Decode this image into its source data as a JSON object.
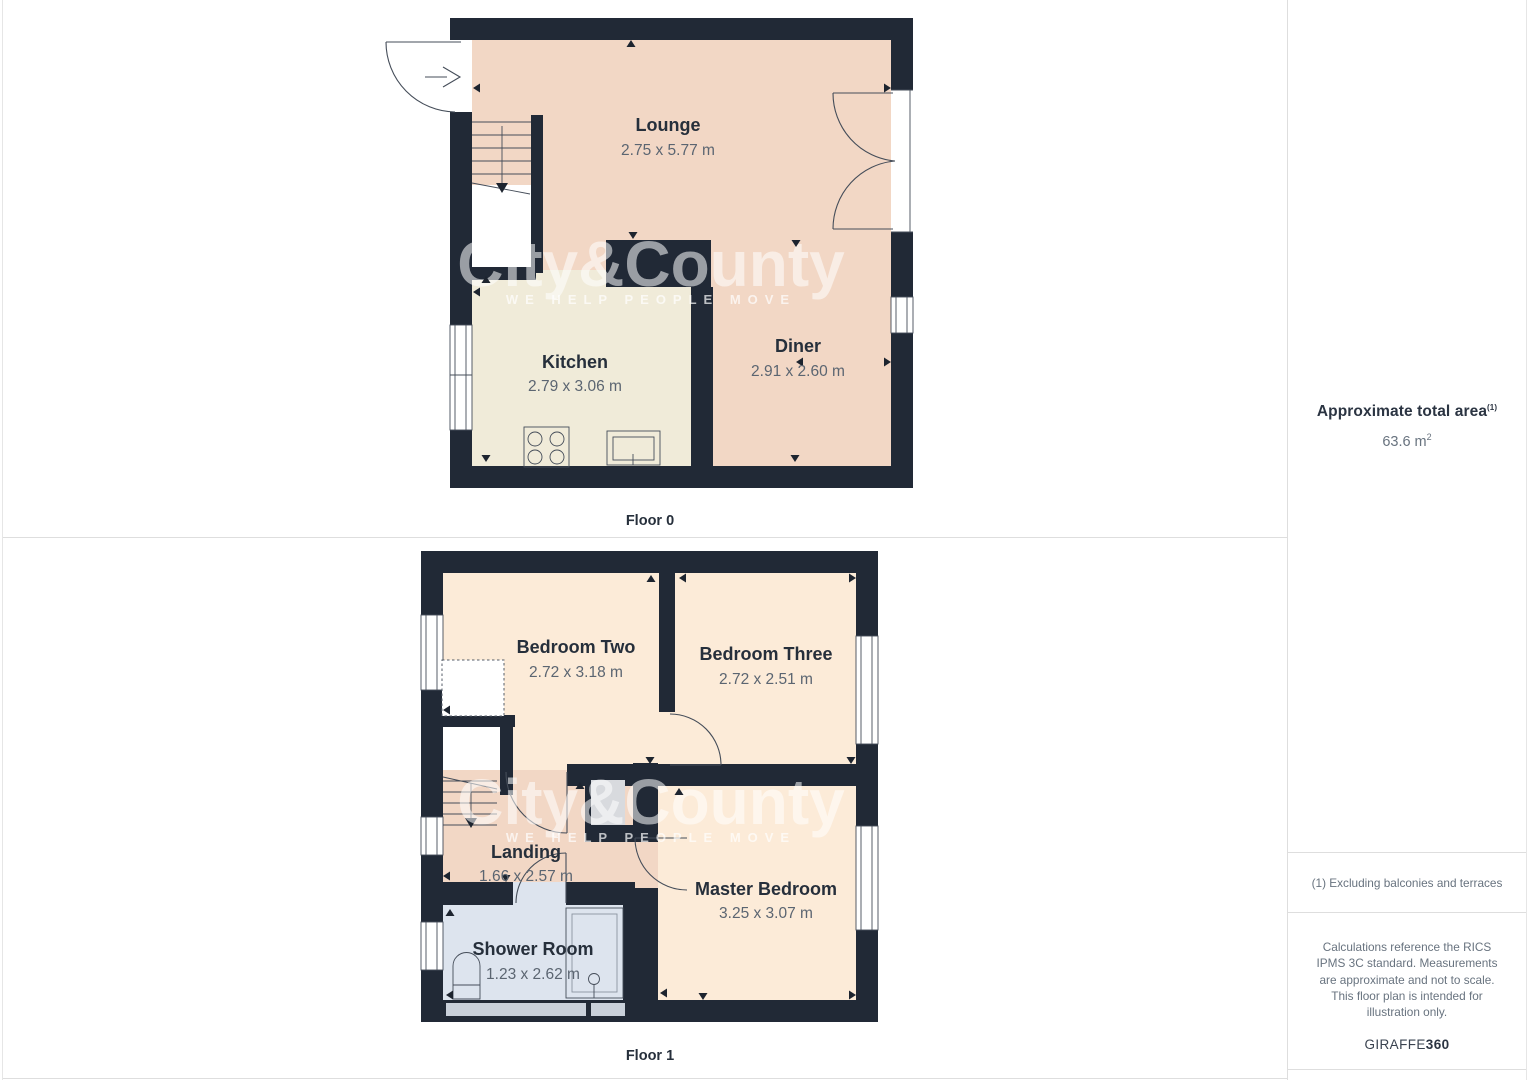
{
  "colors": {
    "wall": "#212936",
    "lounge_fill": "#f2d7c5",
    "kitchen_fill": "#f0ebd9",
    "bedroom_fill": "#fcebd8",
    "shower_fill": "#dde4ee",
    "cupboard_fill": "#d8dade",
    "room_label": "#262f3b",
    "dim_label": "#5b6571",
    "border": "#dedede"
  },
  "floors": [
    {
      "label": "Floor 0",
      "rooms": [
        {
          "name": "Lounge",
          "dims": "2.75 x 5.77 m"
        },
        {
          "name": "Kitchen",
          "dims": "2.79 x 3.06 m"
        },
        {
          "name": "Diner",
          "dims": "2.91 x 2.60 m"
        }
      ]
    },
    {
      "label": "Floor 1",
      "rooms": [
        {
          "name": "Bedroom Two",
          "dims": "2.72 x 3.18 m"
        },
        {
          "name": "Bedroom Three",
          "dims": "2.72 x 2.51 m"
        },
        {
          "name": "Landing",
          "dims": "1.66 x 2.57 m"
        },
        {
          "name": "Master Bedroom",
          "dims": "3.25 x 3.07 m"
        },
        {
          "name": "Shower Room",
          "dims": "1.23 x 2.62 m"
        }
      ]
    }
  ],
  "watermark": {
    "title": "City&County",
    "tagline": "WE HELP PEOPLE MOVE"
  },
  "sidebar": {
    "area_title": "Approximate total area",
    "area_title_sup": "(1)",
    "area_value": "63.6 m",
    "area_value_sup": "2",
    "footnote": "(1) Excluding balconies and terraces",
    "disclaimer": "Calculations reference the RICS IPMS 3C standard. Measurements are approximate and not to scale. This floor plan is intended for illustration only.",
    "brand_primary": "GIRAFFE",
    "brand_secondary": "360"
  }
}
